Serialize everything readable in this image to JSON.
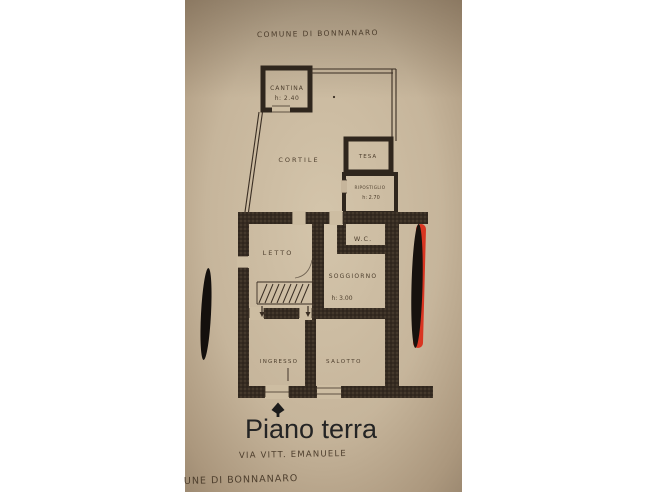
{
  "photo": {
    "type": "scanned floor plan photograph",
    "header_text": "COMUNE DI BONNANARO",
    "footer_text": "UNE DI BONNANARO",
    "caption": {
      "title": "Piano terra",
      "subtitle": "VIA VITT. EMANUELE"
    },
    "plan": {
      "rooms": {
        "cantina": {
          "label": "CANTINA",
          "height": "h: 2.40"
        },
        "cortile": {
          "label": "CORTILE"
        },
        "tesa": {
          "label": "TESA"
        },
        "ripostiglio": {
          "label": "RIPOSTIGLIO",
          "height": "h: 2.70"
        },
        "wc": {
          "label": "W.C."
        },
        "letto": {
          "label": "LETTO"
        },
        "soggiorno": {
          "label": "SOGGIORNO",
          "height": "h: 3.00"
        },
        "ingresso": {
          "label": "INGRESSO"
        },
        "salotto": {
          "label": "SALOTTO"
        }
      }
    },
    "colors": {
      "paper": "#c6b59b",
      "ink": "#3a2e23",
      "wall": "#362c22",
      "redaction": "#17120e",
      "red_stripe": "#e03a28",
      "margin": "#ffffff"
    }
  }
}
